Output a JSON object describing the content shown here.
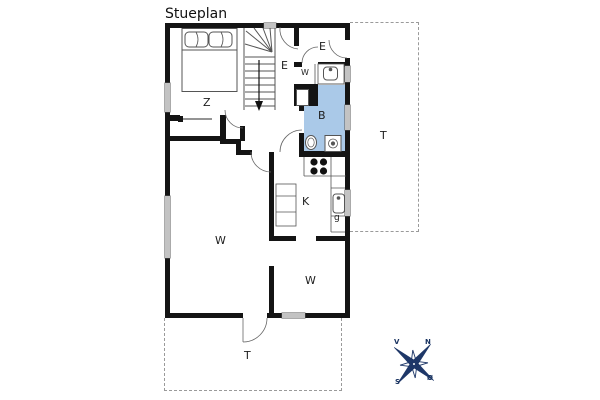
{
  "title": "Stueplan",
  "rooms": {
    "bedroom": "Z",
    "hall": "E",
    "entrance": "E",
    "toilet": "W",
    "bathroom": "B",
    "kitchen": "K",
    "cupboard": "g",
    "living_room": "W",
    "second_room": "W",
    "terrace_right": "T",
    "terrace_bottom": "T"
  },
  "compass": {
    "west": "V",
    "north": "N",
    "south": "S",
    "east": "Ø"
  },
  "colors": {
    "wall": "#141414",
    "window_fill": "#c3c3c3",
    "bathroom_fill": "#aac9e8",
    "dashed_outline": "#9a9a9a",
    "compass_star": "#1e3768",
    "fixture_line": "#444444"
  }
}
